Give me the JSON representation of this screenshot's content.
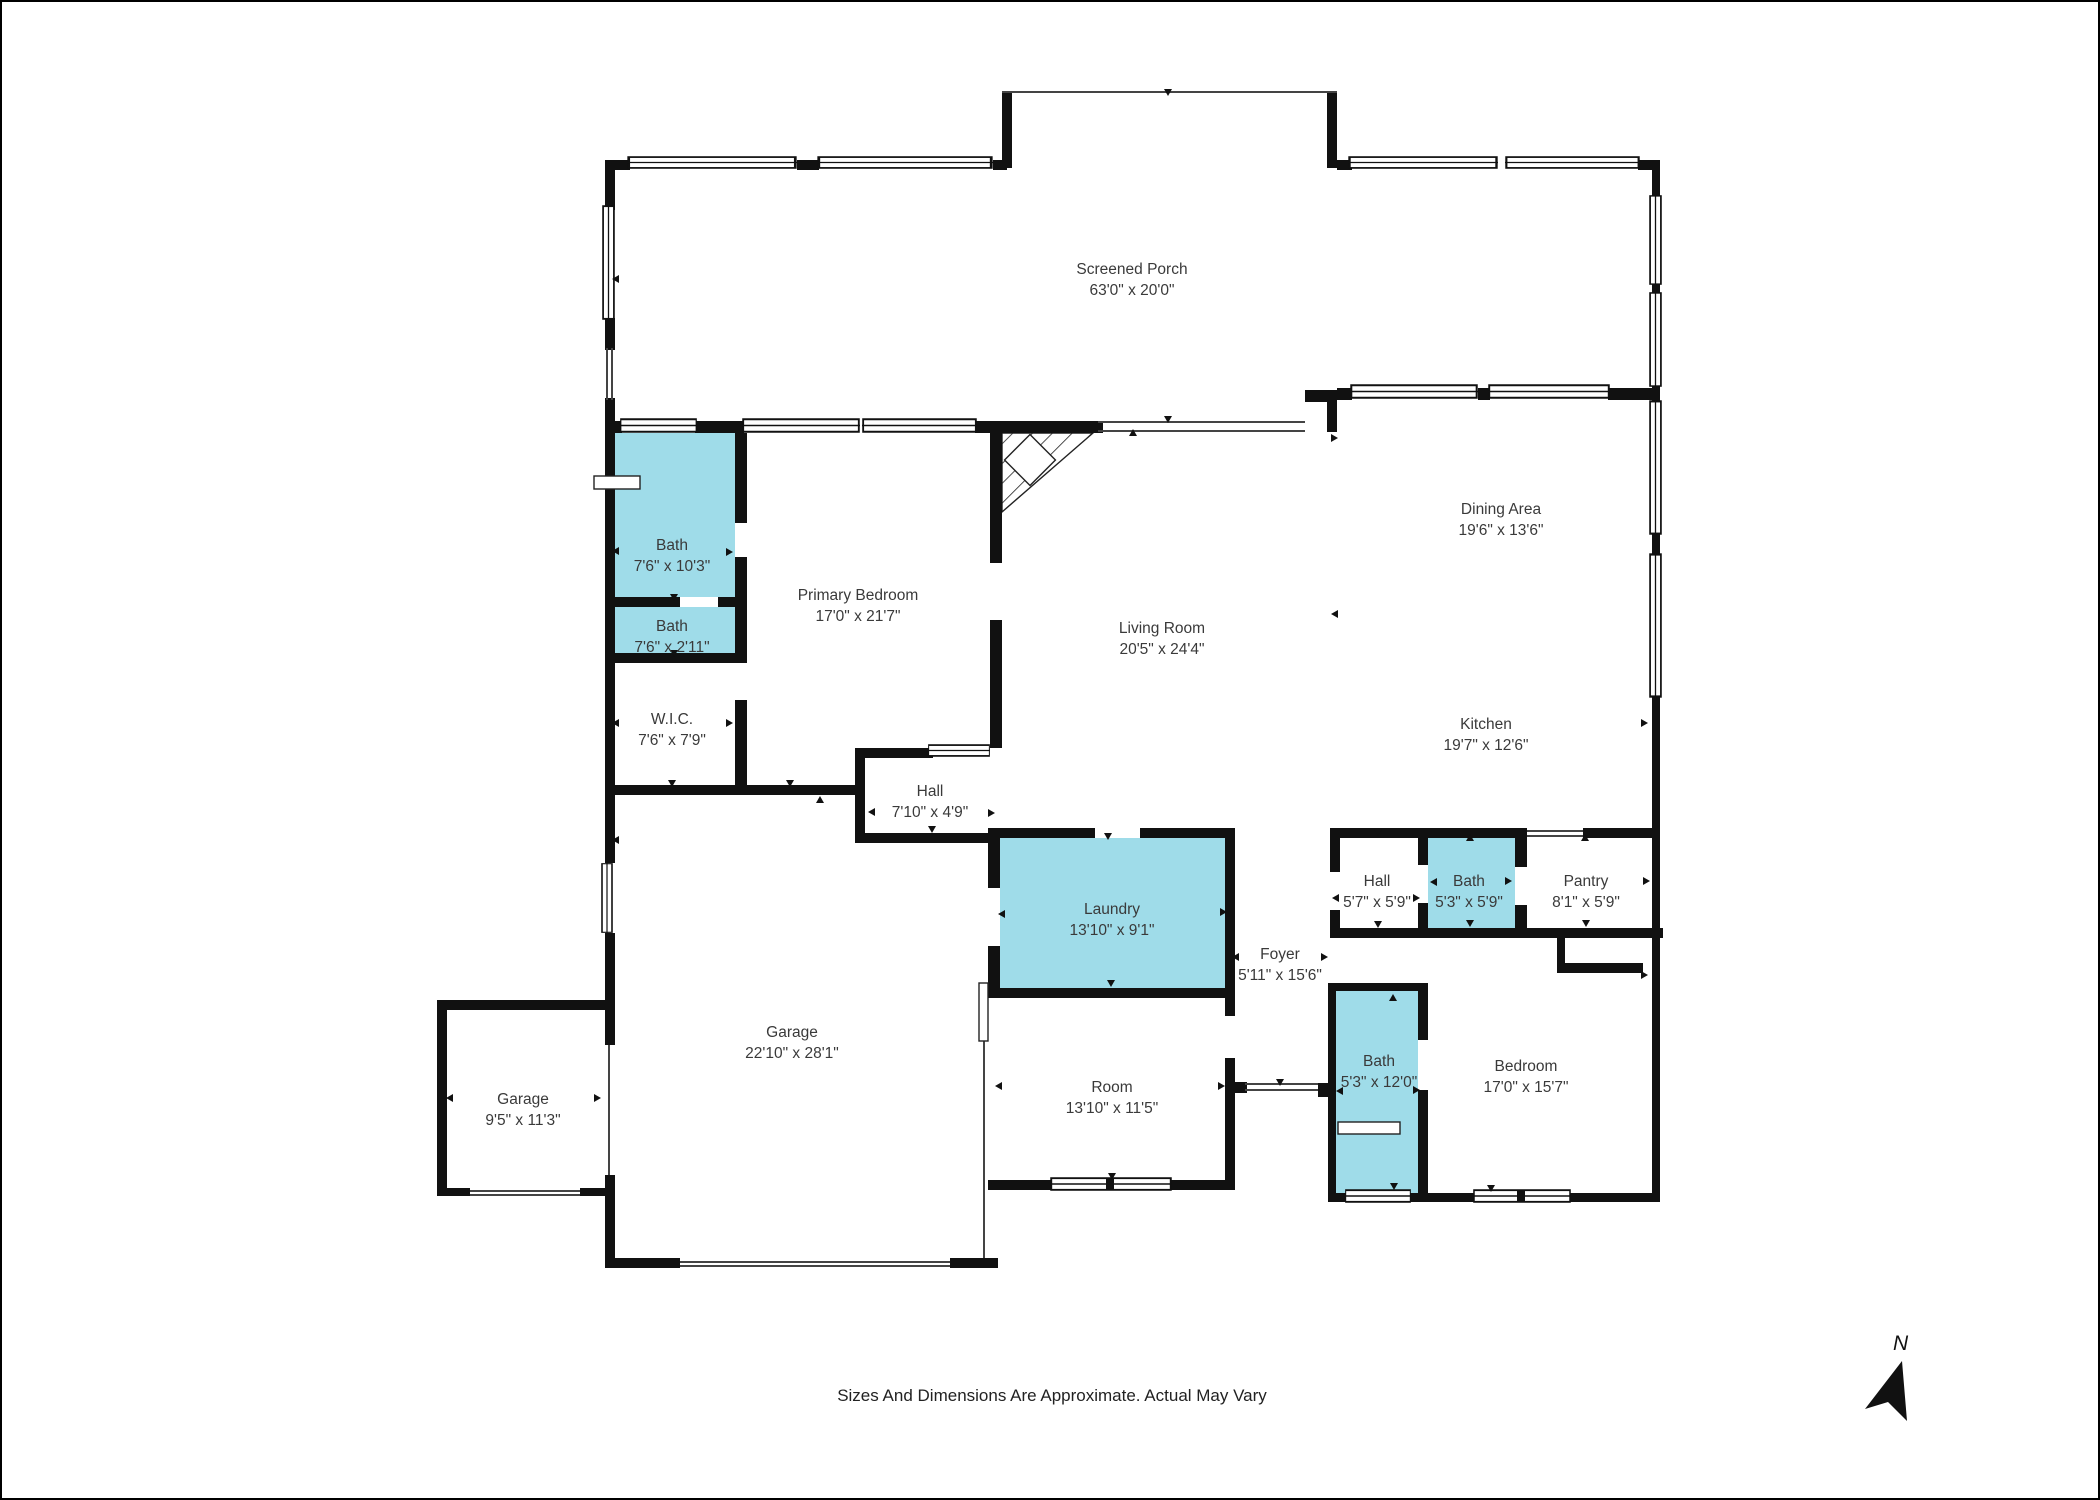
{
  "canvas": {
    "width": 2100,
    "height": 1500,
    "background": "#ffffff",
    "frame_color": "#000000"
  },
  "colors": {
    "wall": "#111111",
    "highlight_room_fill": "#9FDCE9",
    "label_text": "#3a3a3a"
  },
  "footer": {
    "disclaimer": "Sizes And Dimensions Are Approximate. Actual May Vary"
  },
  "compass": {
    "label": "N"
  },
  "rooms": [
    {
      "id": "screened-porch",
      "name": "Screened Porch",
      "dims": "63'0\" x 20'0\"",
      "highlighted": false
    },
    {
      "id": "bath-primary",
      "name": "Bath",
      "dims": "7'6\" x 10'3\"",
      "highlighted": true
    },
    {
      "id": "bath-small",
      "name": "Bath",
      "dims": "7'6\" x 2'11\"",
      "highlighted": true
    },
    {
      "id": "wic",
      "name": "W.I.C.",
      "dims": "7'6\" x 7'9\"",
      "highlighted": false
    },
    {
      "id": "primary-bedroom",
      "name": "Primary Bedroom",
      "dims": "17'0\" x 21'7\"",
      "highlighted": false
    },
    {
      "id": "living-room",
      "name": "Living Room",
      "dims": "20'5\" x 24'4\"",
      "highlighted": false
    },
    {
      "id": "dining-area",
      "name": "Dining Area",
      "dims": "19'6\" x 13'6\"",
      "highlighted": false
    },
    {
      "id": "kitchen",
      "name": "Kitchen",
      "dims": "19'7\" x 12'6\"",
      "highlighted": false
    },
    {
      "id": "hall-west",
      "name": "Hall",
      "dims": "7'10\" x 4'9\"",
      "highlighted": false
    },
    {
      "id": "laundry",
      "name": "Laundry",
      "dims": "13'10\" x 9'1\"",
      "highlighted": true
    },
    {
      "id": "foyer",
      "name": "Foyer",
      "dims": "5'11\" x 15'6\"",
      "highlighted": false
    },
    {
      "id": "hall-east",
      "name": "Hall",
      "dims": "5'7\" x 5'9\"",
      "highlighted": false
    },
    {
      "id": "bath-hall",
      "name": "Bath",
      "dims": "5'3\" x 5'9\"",
      "highlighted": true
    },
    {
      "id": "pantry",
      "name": "Pantry",
      "dims": "8'1\" x 5'9\"",
      "highlighted": false
    },
    {
      "id": "bath-bedroom",
      "name": "Bath",
      "dims": "5'3\" x 12'0\"",
      "highlighted": true
    },
    {
      "id": "bedroom",
      "name": "Bedroom",
      "dims": "17'0\" x 15'7\"",
      "highlighted": false
    },
    {
      "id": "garage-main",
      "name": "Garage",
      "dims": "22'10\" x 28'1\"",
      "highlighted": false
    },
    {
      "id": "garage-small",
      "name": "Garage",
      "dims": "9'5\" x 11'3\"",
      "highlighted": false
    },
    {
      "id": "room",
      "name": "Room",
      "dims": "13'10\" x 11'5\"",
      "highlighted": false
    }
  ]
}
